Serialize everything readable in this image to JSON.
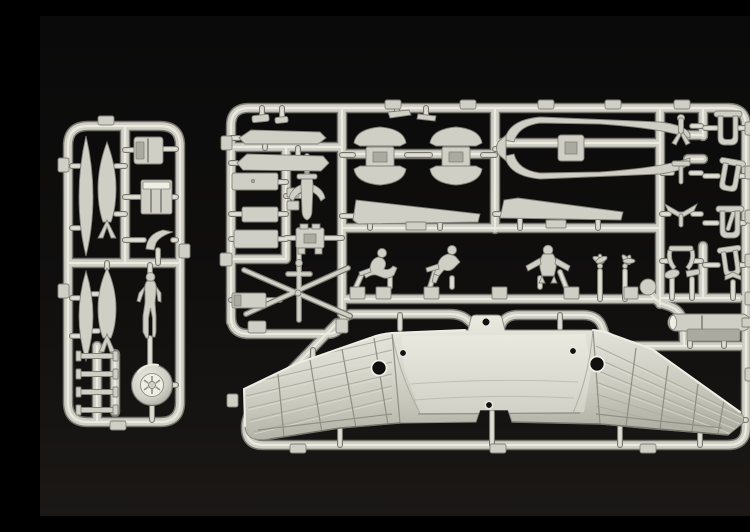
{
  "scene": {
    "type": "photograph",
    "subject": "Injection-molded plastic model kit sprues (parts trees) of a flying-wing aircraft kit, laid on a black studio background",
    "colors": {
      "bg-top": "#0a0a0a",
      "bg-bottom": "#1b1816",
      "plastic": "#cfcfc5",
      "plastic-hl": "#efeee4",
      "plastic-sh": "#75756d",
      "plastic-dk": "#aaaaa0",
      "part-edge": "#82827a",
      "hole": "#101010"
    }
  },
  "sprues": [
    {
      "id": "left-sprue",
      "parts": [
        "slim drop tank",
        "finned bomb",
        "cowling block",
        "engine block",
        "intake pipe",
        "second drop tank",
        "second finned bomb",
        "standing pilot figure",
        "spoked wheel",
        "four sway-brace clamps"
      ]
    },
    {
      "id": "main-sprue",
      "parts": [
        "two elevon blades",
        "three hatch panels",
        "seat mount",
        "equipment box",
        "gun tripod",
        "two engine nacelle halves with mounting rings",
        "fuselage spine halves",
        "two leading-edge blades",
        "three seated crew figures",
        "two small propellers",
        "eight landing-gear yokes",
        "gate tabs"
      ]
    },
    {
      "id": "wing-runner",
      "parts": [
        "one-piece flying-wing lower half with ribbed panels, two round openings and a center mounting tab",
        "engine pod"
      ]
    }
  ]
}
